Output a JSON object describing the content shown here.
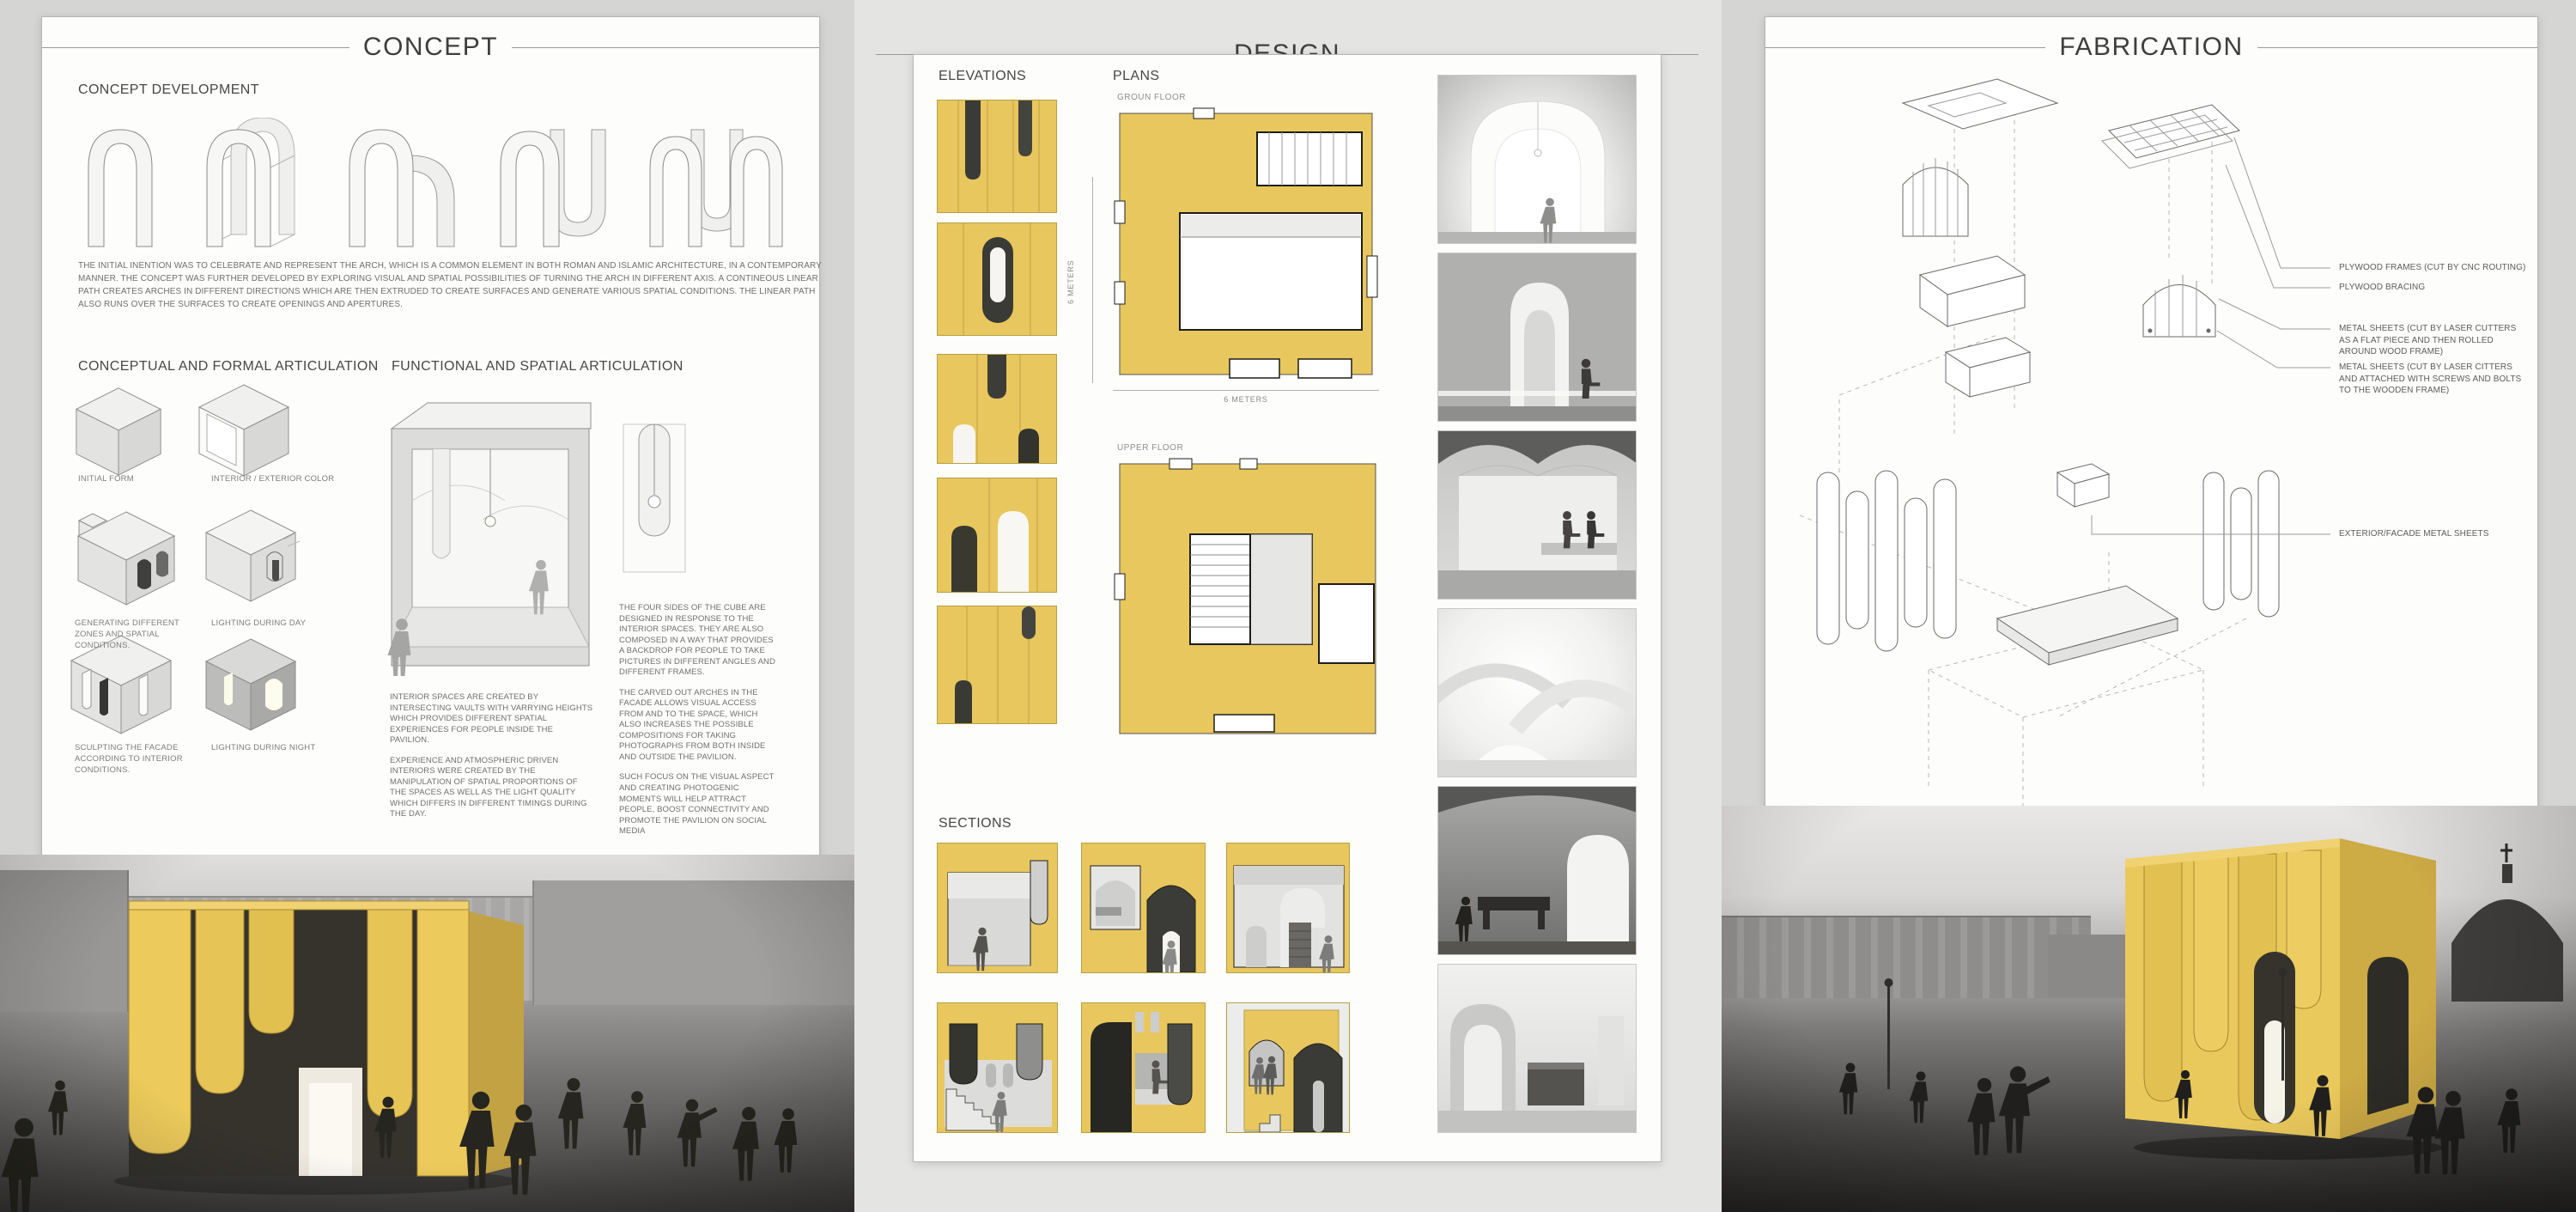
{
  "concept": {
    "title": "CONCEPT",
    "development_heading": "CONCEPT DEVELOPMENT",
    "intro_text": "THE INITIAL INENTION WAS TO CELEBRATE AND REPRESENT THE ARCH, WHICH IS A COMMON ELEMENT IN BOTH ROMAN AND ISLAMIC ARCHITECTURE, IN A CONTEMPORARY MANNER. THE CONCEPT WAS FURTHER DEVELOPED BY EXPLORING VISUAL AND SPATIAL POSSIBILITIES OF TURNING THE ARCH IN DIFFERENT AXIS. A CONTINEOUS LINEAR PATH CREATES ARCHES IN DIFFERENT DIRECTIONS WHICH ARE THEN EXTRUDED TO CREATE SURFACES AND GENERATE VARIOUS SPATIAL CONDITIONS. THE LINEAR PATH ALSO RUNS OVER THE SURFACES TO CREATE OPENINGS AND APERTURES.",
    "formal_heading": "CONCEPTUAL AND FORMAL ARTICULATION",
    "spatial_heading": "FUNCTIONAL AND SPATIAL ARTICULATION",
    "diagram_labels": [
      "INITIAL FORM",
      "INTERIOR / EXTERIOR COLOR",
      "GENERATING DIFFERENT ZONES AND SPATIAL CONDITIONS.",
      "LIGHTING DURING DAY",
      "SCULPTING THE FACADE ACCORDING TO INTERIOR CONDITIONS.",
      "LIGHTING DURING NIGHT"
    ],
    "interior_paragraphs": [
      "INTERIOR SPACES ARE CREATED BY INTERSECTING VAULTS WITH VARRYING HEIGHTS WHICH PROVIDES DIFFERENT SPATIAL EXPERIENCES FOR PEOPLE INSIDE THE PAVILION.",
      "EXPERIENCE AND ATMOSPHERIC DRIVEN INTERIORS WERE CREATED BY THE MANIPULATION OF SPATIAL PROPORTIONS OF THE SPACES AS WELL AS THE LIGHT QUALITY WHICH DIFFERS IN DIFFERENT TIMINGS DURING THE DAY."
    ],
    "facade_paragraphs": [
      "THE FOUR SIDES OF THE CUBE ARE DESIGNED IN RESPONSE TO THE INTERIOR SPACES. THEY ARE ALSO COMPOSED IN A WAY THAT PROVIDES A BACKDROP FOR PEOPLE TO TAKE PICTURES IN DIFFERENT ANGLES AND DIFFERENT FRAMES.",
      "THE CARVED OUT ARCHES IN THE FACADE ALLOWS VISUAL ACCESS FROM AND TO THE SPACE, WHICH ALSO INCREASES THE POSSIBLE COMPOSITIONS FOR TAKING PHOTOGRAPHS FROM BOTH INSIDE AND OUTSIDE THE PAVILION.",
      "SUCH FOCUS ON THE VISUAL ASPECT AND CREATING PHOTOGENIC MOMENTS WILL HELP ATTRACT PEOPLE, BOOST CONNECTIVITY AND  PROMOTE THE PAVILION ON SOCIAL MEDIA"
    ]
  },
  "design": {
    "title": "DESIGN",
    "elevations_heading": "ELEVATIONS",
    "plans_heading": "PLANS",
    "ground_floor_label": "GROUN FLOOR",
    "upper_floor_label": "UPPER FLOOR",
    "plan_height_label": "6 METERS",
    "plan_width_label": "6 METERS",
    "sections_heading": "SECTIONS"
  },
  "fabrication": {
    "title": "FABRICATION",
    "callouts": [
      "PLYWOOD FRAMES (CUT BY CNC ROUTING)",
      "PLYWOOD BRACING",
      "METAL SHEETS (CUT BY LASER CUTTERS AS A FLAT PIECE AND THEN ROLLED AROUND WOOD FRAME)",
      "METAL SHEETS (CUT BY LASER CITTERS AND ATTACHED WITH SCREWS AND BOLTS TO THE WOODEN FRAME)",
      "EXTERIOR/FACADE METAL SHEETS"
    ]
  },
  "colors": {
    "accent_yellow": "#e8c75e",
    "accent_yellow_dark": "#caa63f",
    "board_bg": "#fdfdfc",
    "page_bg_outer": "#d5d5d3",
    "page_bg_middle": "#e4e4e2",
    "ink": "#3e3e3c",
    "line": "#9a9a97"
  }
}
